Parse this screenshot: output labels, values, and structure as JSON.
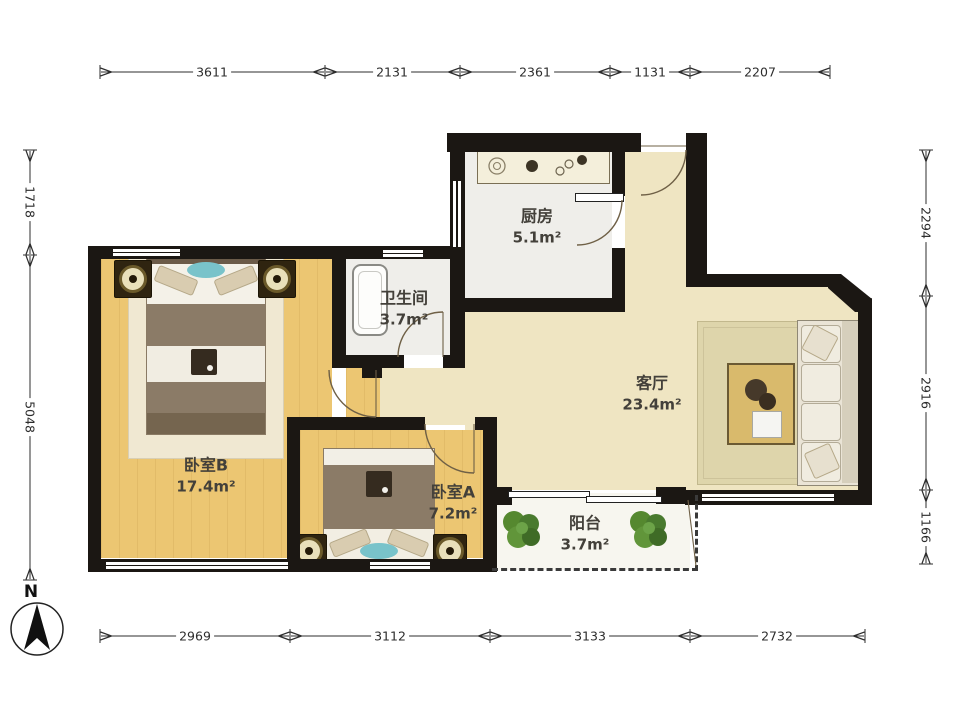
{
  "plan_title": "2-bedroom apartment floor plan",
  "rooms": {
    "kitchen": {
      "label": "厨房",
      "area": "5.1m²"
    },
    "bathroom": {
      "label": "卫生间",
      "area": "3.7m²"
    },
    "living": {
      "label": "客厅",
      "area": "23.4m²"
    },
    "bedroomB": {
      "label": "卧室B",
      "area": "17.4m²"
    },
    "bedroomA": {
      "label": "卧室A",
      "area": "7.2m²"
    },
    "balcony": {
      "label": "阳台",
      "area": "3.7m²"
    }
  },
  "dimensions": {
    "top": [
      "3611",
      "2131",
      "2361",
      "1131",
      "2207"
    ],
    "bottom": [
      "2969",
      "3112",
      "3133",
      "2732"
    ],
    "left": [
      "1718",
      "5048"
    ],
    "right": [
      "2294",
      "2916",
      "1166"
    ]
  },
  "compass": {
    "label": "N"
  },
  "colors": {
    "wall": "#1b1713",
    "wood_floor": "#ecc672",
    "hall_floor": "#efe5c2",
    "tile_floor": "#efeeea",
    "balcony_floor": "#f7f6ef",
    "accent_teal": "#79c3ca",
    "plant_green": "#55882f",
    "dimension_text": "#2d2d2d"
  }
}
